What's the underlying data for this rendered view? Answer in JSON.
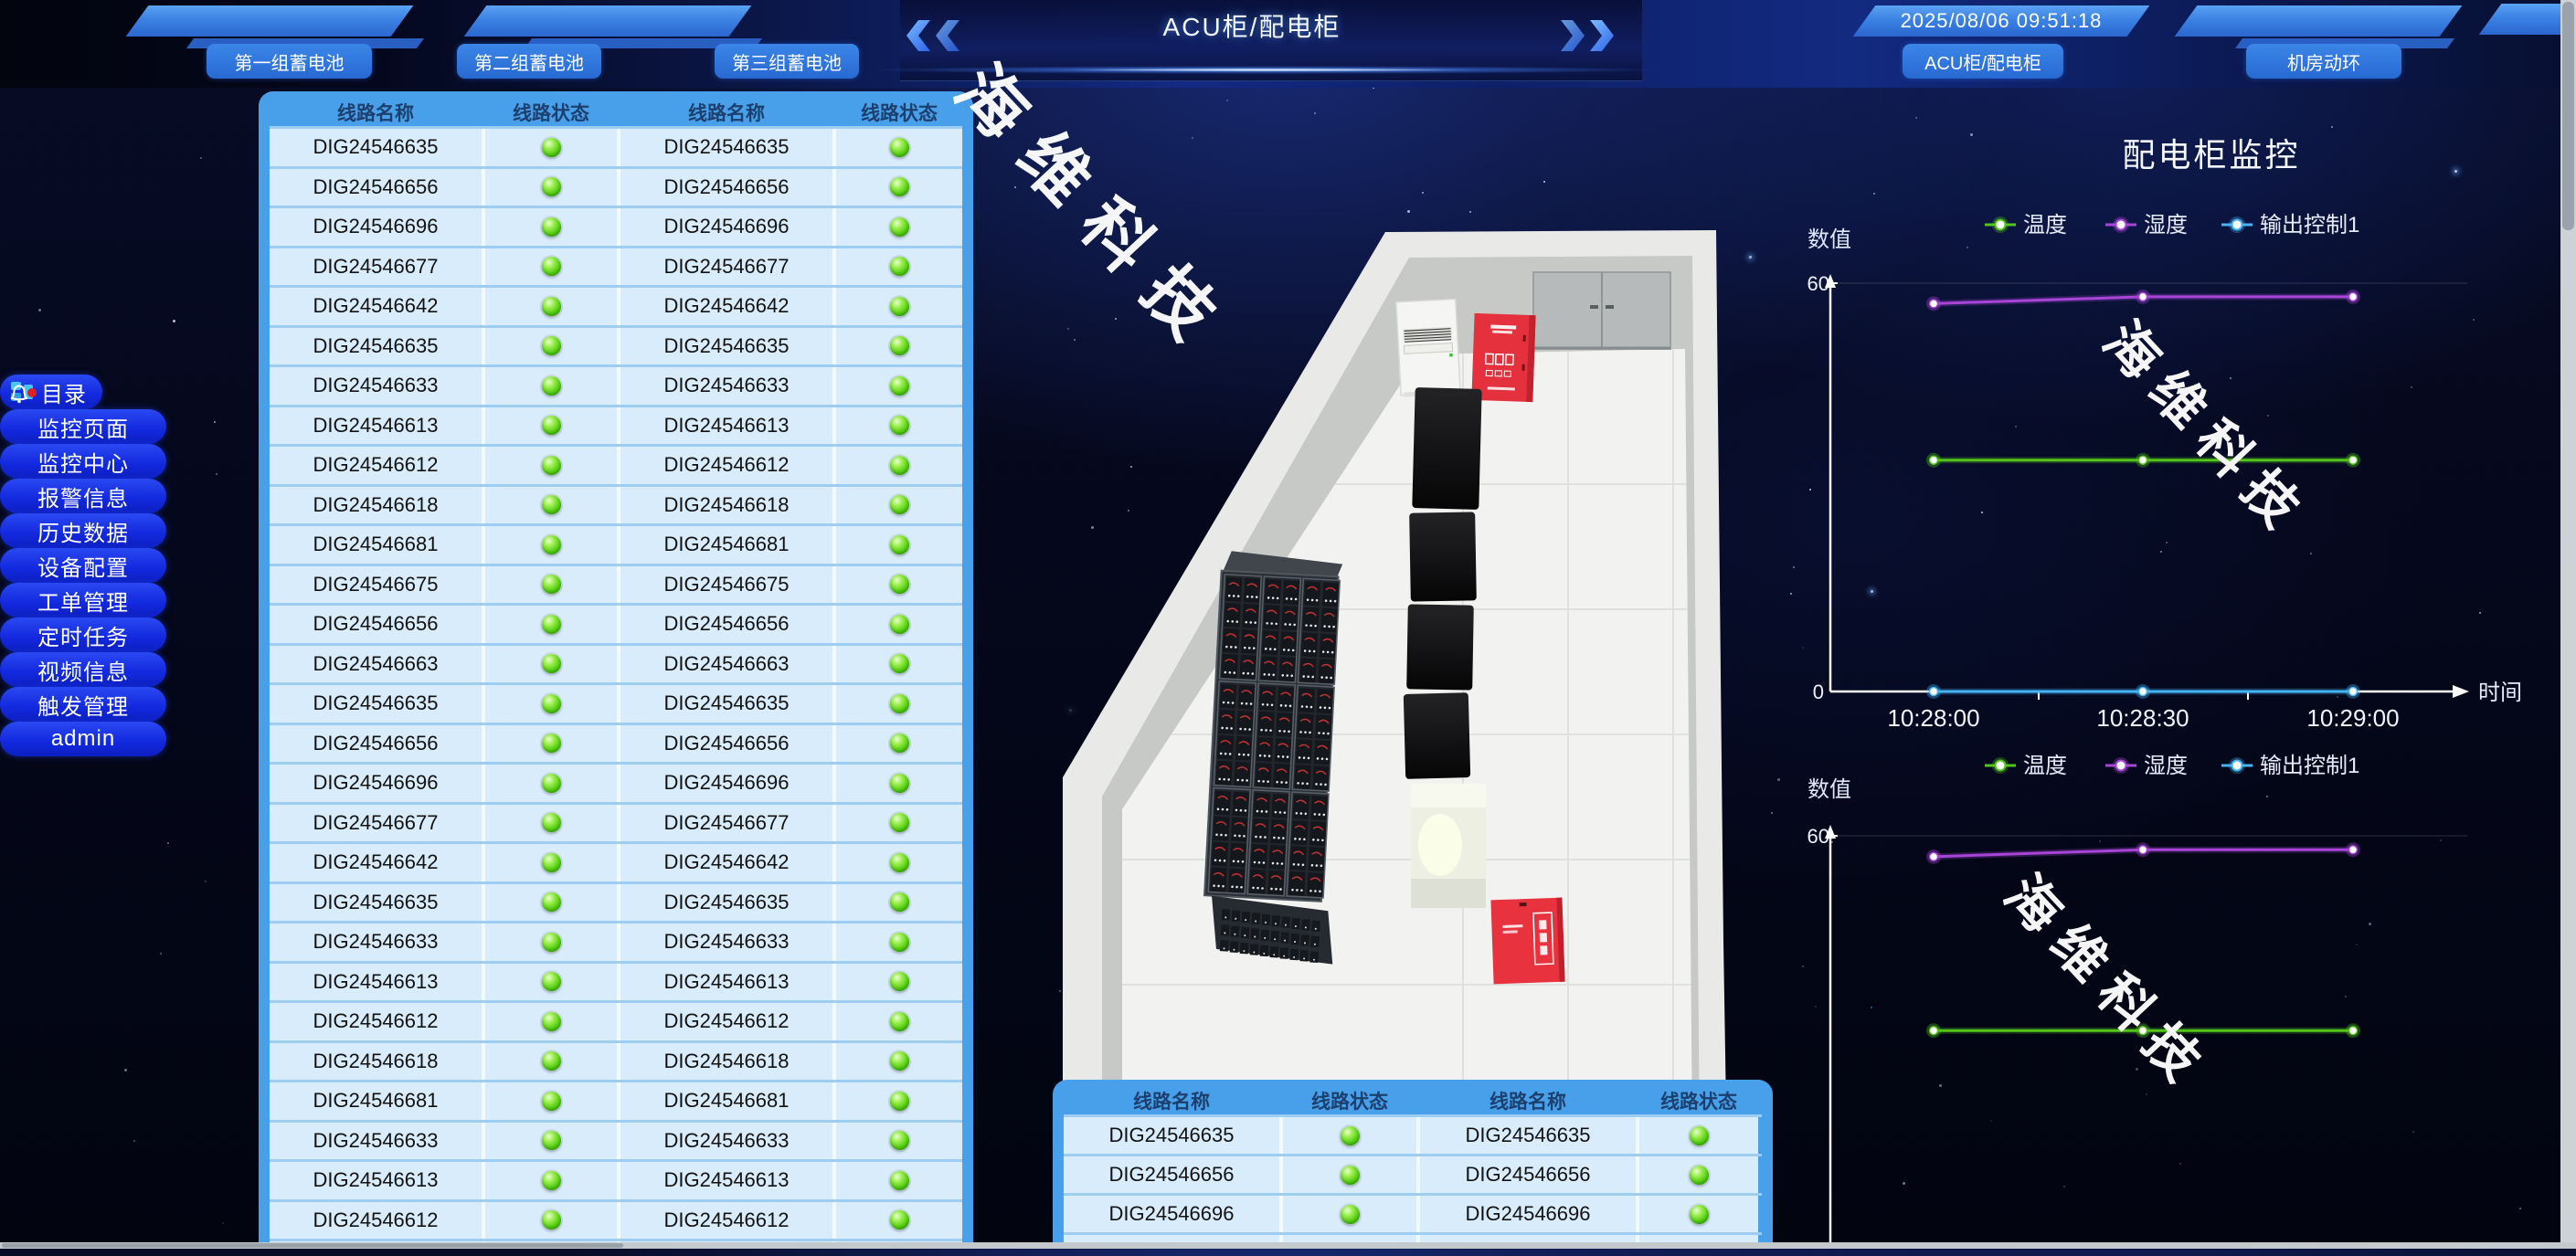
{
  "header": {
    "title": "ACU柜/配电柜",
    "timestamp": "2025/08/06 09:51:18",
    "left_buttons": [
      "第一组蓄电池",
      "第二组蓄电池",
      "第三组蓄电池"
    ],
    "right_buttons": [
      "ACU柜/配电柜",
      "机房动环"
    ]
  },
  "sidebar": {
    "items": [
      {
        "label": "目录",
        "icon": "menu-grid-icon"
      },
      {
        "label": "监控页面"
      },
      {
        "label": "监控中心"
      },
      {
        "label": "报警信息",
        "icon": "bell-icon",
        "badge": true
      },
      {
        "label": "历史数据"
      },
      {
        "label": "设备配置"
      },
      {
        "label": "工单管理"
      },
      {
        "label": "定时任务"
      },
      {
        "label": "视频信息"
      },
      {
        "label": "触发管理"
      },
      {
        "label": "admin"
      }
    ]
  },
  "tables": {
    "columns": [
      "线路名称",
      "线路状态",
      "线路名称",
      "线路状态"
    ],
    "status": "on",
    "status_color": "#4ec709",
    "main_rows": [
      "DIG24546635",
      "DIG24546656",
      "DIG24546696",
      "DIG24546677",
      "DIG24546642",
      "DIG24546635",
      "DIG24546633",
      "DIG24546613",
      "DIG24546612",
      "DIG24546618",
      "DIG24546681",
      "DIG24546675",
      "DIG24546656",
      "DIG24546663",
      "DIG24546635",
      "DIG24546656",
      "DIG24546696",
      "DIG24546677",
      "DIG24546642",
      "DIG24546635",
      "DIG24546633",
      "DIG24546613",
      "DIG24546612",
      "DIG24546618",
      "DIG24546681",
      "DIG24546633",
      "DIG24546613",
      "DIG24546612",
      "DIG24546618"
    ],
    "bottom_rows": [
      "DIG24546635",
      "DIG24546656",
      "DIG24546696",
      "DIG24546677"
    ]
  },
  "watermark": {
    "text": "海维科技"
  },
  "room": {
    "equipment": [
      "door",
      "air-conditioner",
      "fire-cabinet",
      "server-rack",
      "battery-rack",
      "ups-box",
      "fire-cabinet-2"
    ]
  },
  "chart_data": [
    {
      "type": "line",
      "title": "配电柜监控",
      "ylabel": "数值",
      "xlabel": "时间",
      "ylim": [
        0,
        60
      ],
      "y_ticks": [
        "60",
        "0"
      ],
      "x": [
        "10:28:00",
        "10:28:30",
        "10:29:00"
      ],
      "legend_position": "top",
      "grid": false,
      "series": [
        {
          "name": "温度",
          "color": "#52c41a",
          "values": [
            34,
            34,
            34
          ]
        },
        {
          "name": "湿度",
          "color": "#a845d8",
          "values": [
            57,
            58,
            58
          ]
        },
        {
          "name": "输出控制1",
          "color": "#45b4f5",
          "values": [
            0,
            0,
            0
          ]
        }
      ]
    },
    {
      "type": "line",
      "title": "",
      "ylabel": "数值",
      "xlabel": "",
      "ylim": [
        0,
        60
      ],
      "y_ticks": [
        "60"
      ],
      "x": [
        "10:28:00",
        "10:28:30",
        "10:29:00"
      ],
      "legend_position": "top",
      "grid": false,
      "series": [
        {
          "name": "温度",
          "color": "#52c41a",
          "values": [
            32,
            32,
            32
          ]
        },
        {
          "name": "湿度",
          "color": "#a845d8",
          "values": [
            57,
            58,
            58
          ]
        },
        {
          "name": "输出控制1",
          "color": "#45b4f5",
          "values": [
            0,
            0,
            0
          ]
        }
      ]
    }
  ]
}
